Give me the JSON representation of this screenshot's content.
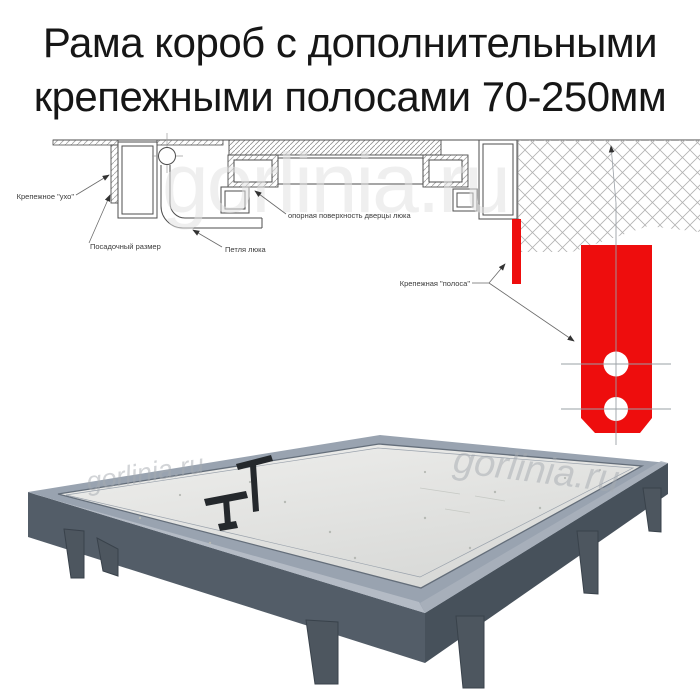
{
  "title": {
    "line1": "Рама короб с дополнительными",
    "line2": "крепежными полосами 70-250мм"
  },
  "watermark": "gorlinia.ru",
  "diagram": {
    "labels": {
      "mounting_ear": "Крепежное \"ухо\"",
      "seating_size": "Посадочный размер",
      "hatch_hinge": "Петля люка",
      "door_support_surface": "опорная поверхность дверцы люка",
      "mounting_strip": "Крепежная \"полоса\""
    },
    "colors": {
      "strip_red": "#ee0d0d",
      "line": "#4d4d4d",
      "centerline": "#9aa0a6",
      "watermark": "#e2e2e2"
    }
  },
  "photo": {
    "colors": {
      "rim": "#99a3b0",
      "rim_highlight": "#b4bbc5",
      "side_left": "#535d68",
      "side_right": "#47515b",
      "panel": "#e9eae8",
      "legs": "#4d565f",
      "handles": "#24282c",
      "watermark": "#a6abb1"
    }
  }
}
